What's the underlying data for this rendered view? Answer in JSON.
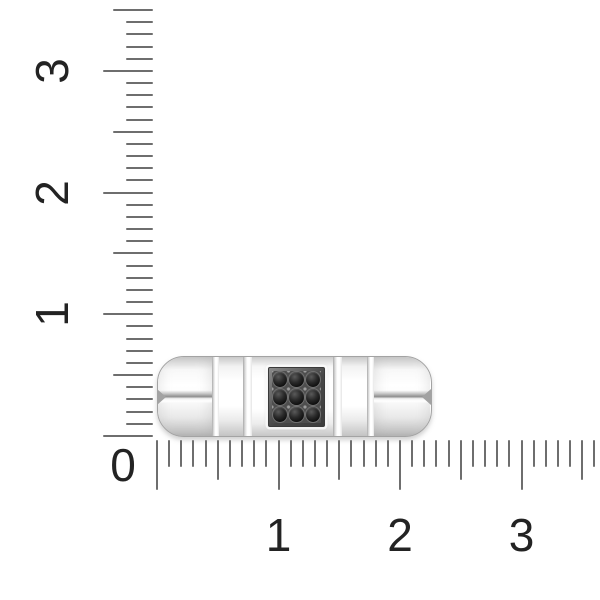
{
  "scene": {
    "description": "Top view of a polished white-metal band ring with a square pave panel of nine black stones, photographed against metric size rulers",
    "background_color": "#ffffff"
  },
  "rulers": {
    "tick_color": "#6e6e6e",
    "label_color": "#232323",
    "corner_label": "0",
    "vertical": {
      "unit_labels": [
        "1",
        "2",
        "3"
      ],
      "max_units": 3.5,
      "minor_step": 0.1,
      "px_per_unit": 121.67,
      "origin_y": 436,
      "line_x": 153,
      "tick_len_minor": 27,
      "tick_len_half": 40,
      "tick_len_major": 50,
      "label_center_x": 52,
      "label_rotation_deg": -90
    },
    "horizontal": {
      "unit_labels": [
        "1",
        "2",
        "3"
      ],
      "max_units": 3.6,
      "minor_step": 0.1,
      "px_per_unit": 121.5,
      "origin_x": 157,
      "line_y": 440,
      "tick_len_minor": 27,
      "tick_len_half": 40,
      "tick_len_major": 50,
      "label_center_y": 535
    },
    "corner_label_center": {
      "x": 123,
      "y": 465
    }
  },
  "ring": {
    "metal_color_light": "#ffffff",
    "metal_color_mid": "#ececec",
    "metal_color_dark": "#bcbcbc",
    "outline_color": "#a3a3a3",
    "stone_color": "#1c1c1c",
    "plate_frame_color": "#474747",
    "stone_grid": {
      "rows": 3,
      "cols": 3,
      "count": 9
    },
    "span_units_horizontal": 2.25,
    "span_units_vertical": 0.65
  }
}
